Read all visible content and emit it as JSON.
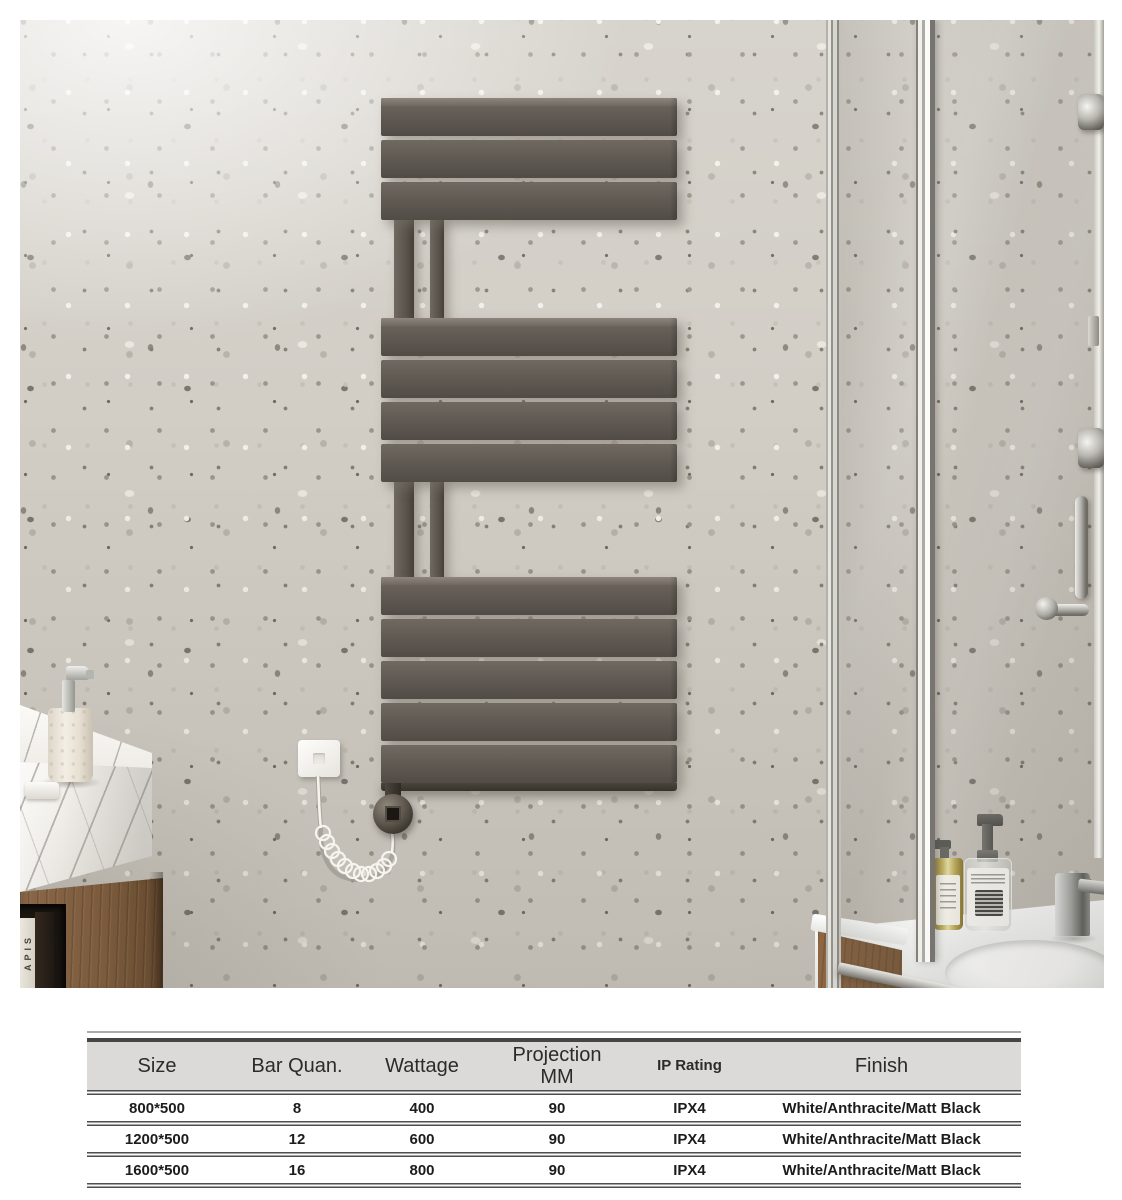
{
  "photo": {
    "book_spine_text": "APIS"
  },
  "table": {
    "headers": [
      "Size",
      "Bar Quan.",
      "Wattage",
      "Projection\nMM",
      "IP Rating",
      "Finish"
    ],
    "rows": [
      [
        "800*500",
        "8",
        "400",
        "90",
        "IPX4",
        "White/Anthracite/Matt Black"
      ],
      [
        "1200*500",
        "12",
        "600",
        "90",
        "IPX4",
        "White/Anthracite/Matt Black"
      ],
      [
        "1600*500",
        "16",
        "800",
        "90",
        "IPX4",
        "White/Anthracite/Matt Black"
      ]
    ]
  },
  "colors": {
    "radiator_anthracite": "#5f5851",
    "wall_terrazzo_base": "#d2cec6",
    "marble_white": "#f5f3ef",
    "walnut_wood": "#7f5e3e",
    "chrome": "#c7c6c2",
    "amber_glass": "#c2b25c",
    "table_header_bg": "#dbdad8",
    "table_line": "#4e4e4e"
  }
}
